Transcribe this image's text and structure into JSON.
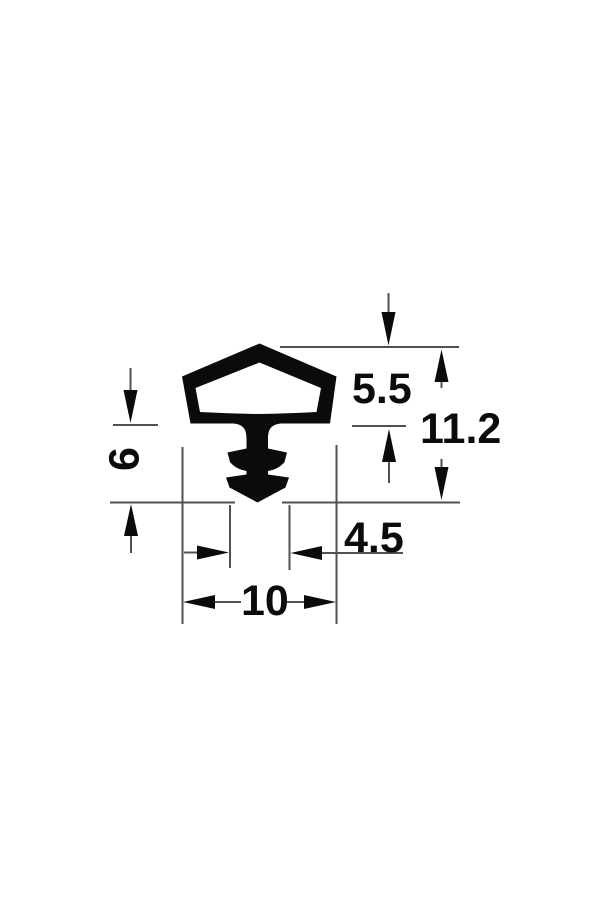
{
  "drawing": {
    "kind": "technical-profile-cross-section",
    "background_color": "#ffffff",
    "dimension_line_color": "#515151",
    "ink_color": "#0b0b0b",
    "dimensions": {
      "cap_height": {
        "value": "5.5"
      },
      "overall_height": {
        "value": "11.2"
      },
      "stem_height": {
        "value": "6"
      },
      "barb_width": {
        "value": "4.5"
      },
      "overall_width": {
        "value": "10"
      }
    }
  }
}
